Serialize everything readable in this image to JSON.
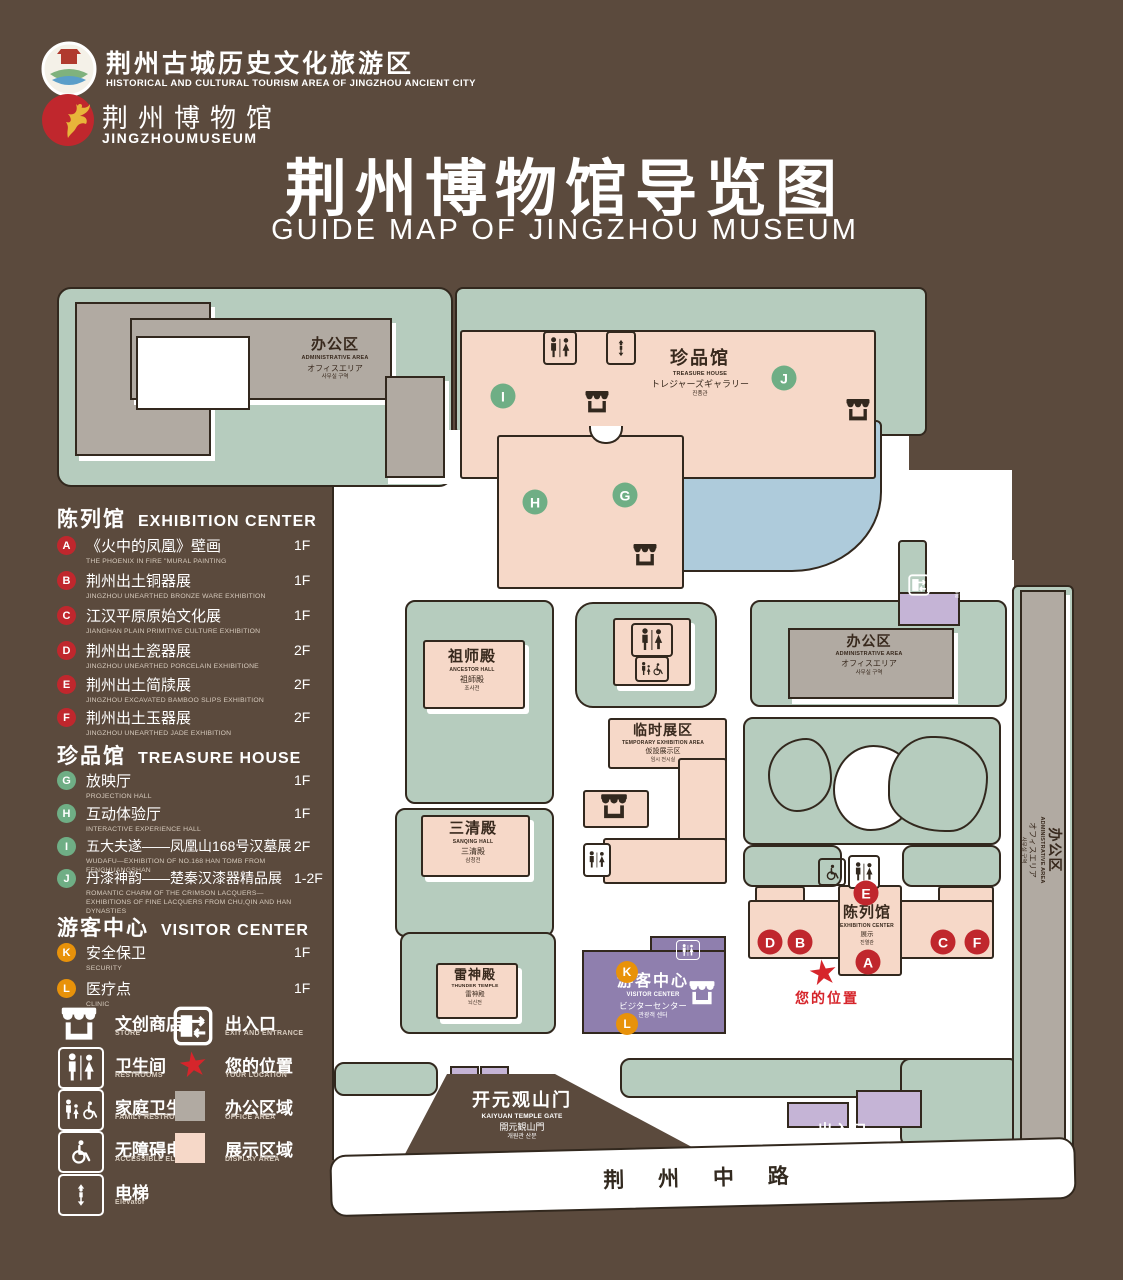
{
  "header": {
    "logo1": {
      "title": "荆州古城历史文化旅游区",
      "subtitle": "HISTORICAL AND CULTURAL TOURISM AREA OF JINGZHOU ANCIENT CITY"
    },
    "logo2": {
      "title": "荆州博物馆",
      "subtitle": "JINGZHOUMUSEUM"
    },
    "title": "荆州博物馆导览图",
    "subtitle": "GUIDE MAP OF JINGZHOU MUSEUM"
  },
  "legend": {
    "sections": [
      {
        "zh": "陈列馆",
        "en": "EXHIBITION CENTER",
        "items": [
          {
            "code": "A",
            "zh": "《火中的凤凰》壁画",
            "en": "THE PHOENIX IN FIRE \"MURAL PAINTING",
            "floor": "1F"
          },
          {
            "code": "B",
            "zh": "荆州出土铜器展",
            "en": "JINGZHOU UNEARTHED BRONZE WARE EXHIBITION",
            "floor": "1F"
          },
          {
            "code": "C",
            "zh": "江汉平原原始文化展",
            "en": "JIANGHAN PLAIN PRIMITIVE CULTURE EXHIBITION",
            "floor": "1F"
          },
          {
            "code": "D",
            "zh": "荆州出土瓷器展",
            "en": "JINGZHOU UNEARTHED PORCELAIN EXHIBITIONE",
            "floor": "2F"
          },
          {
            "code": "E",
            "zh": "荆州出土简牍展",
            "en": "JINGZHOU EXCAVATED BAMBOO SLIPS EXHIBITION",
            "floor": "2F"
          },
          {
            "code": "F",
            "zh": "荆州出土玉器展",
            "en": "JINGZHOU UNEARTHED JADE EXHIBITION",
            "floor": "2F"
          }
        ]
      },
      {
        "zh": "珍品馆",
        "en": "TREASURE HOUSE",
        "items": [
          {
            "code": "G",
            "zh": "放映厅",
            "en": "PROJECTION HALL",
            "floor": "1F"
          },
          {
            "code": "H",
            "zh": "互动体验厅",
            "en": "INTERACTIVE EXPERIENCE HALL",
            "floor": "1F"
          },
          {
            "code": "I",
            "zh": "五大夫遂——凤凰山168号汉墓展",
            "en": "WUDAFU—EXHIBITION OF NO.168 HAN TOMB FROM FENGHUANGSHAN",
            "floor": "2F"
          },
          {
            "code": "J",
            "zh": "丹漆神韵——楚秦汉漆器精品展",
            "en": "ROMANTIC CHARM OF THE CRIMSON LACQUERS—EXHIBITIONS OF FINE LACQUERS FROM CHU,QIN AND HAN DYNASTIES",
            "floor": "1-2F"
          }
        ]
      },
      {
        "zh": "游客中心",
        "en": "VISITOR CENTER",
        "items": [
          {
            "code": "K",
            "zh": "安全保卫",
            "en": "SECURITY",
            "floor": "1F"
          },
          {
            "code": "L",
            "zh": "医疗点",
            "en": "CLINIC",
            "floor": "1F"
          }
        ]
      }
    ],
    "symbols": [
      {
        "zh": "文创商店",
        "en": "STORE"
      },
      {
        "zh": "卫生间",
        "en": "RESTROOMS"
      },
      {
        "zh": "家庭卫生间",
        "en": "FAMILY RESTROOMS"
      },
      {
        "zh": "无障碍电梯",
        "en": "ACCESSIBLE ELEVATOR"
      },
      {
        "zh": "电梯",
        "en": "Elevator"
      },
      {
        "zh": "出入口",
        "en": "EXIT AND ENTRANCE"
      },
      {
        "zh": "您的位置",
        "en": "YOUR LOCATION"
      },
      {
        "zh": "办公区域",
        "en": "OFFICE AREA"
      },
      {
        "zh": "展示区域",
        "en": "DISPLAY AREA"
      }
    ]
  },
  "map": {
    "admin": {
      "zh": "办公区",
      "en": "ADMINISTRATIVE AREA",
      "ja": "オフィスエリア",
      "ko": "사무실 구역"
    },
    "treasure": {
      "zh": "珍品馆",
      "en": "TREASURE HOUSE",
      "ja": "トレジャーズギャラリー",
      "ko": "진품관"
    },
    "ancestor": {
      "zh": "祖师殿",
      "en": "ANCESTOR HALL",
      "ja": "祖師殿",
      "ko": "조사전"
    },
    "sanqing": {
      "zh": "三清殿",
      "en": "SANQING HALL",
      "ja": "三清殿",
      "ko": "삼청전"
    },
    "temporary": {
      "zh": "临时展区",
      "en": "TEMPORARY EXHIBITION AREA",
      "ja": "仮設展示区",
      "ko": "임시 전시실"
    },
    "thunder": {
      "zh": "雷神殿",
      "en": "THUNDER TEMPLE",
      "ja": "雷神殿",
      "ko": "뇌신전"
    },
    "exhibition": {
      "zh": "陈列馆",
      "en": "EXHIBITION CENTER",
      "ja": "展示",
      "ko": "진열관"
    },
    "visitor": {
      "zh": "游客中心",
      "en": "VISITOR CENTER",
      "ja": "ビジターセンター",
      "ko": "관광객 센터"
    },
    "gate": {
      "zh": "开元观山门",
      "en": "KAIYUAN TEMPLE GATE",
      "ja": "開元観山門",
      "ko": "개원관 산문"
    },
    "exit": {
      "zh": "出入口",
      "en": "EXIT AND ENTRANCE",
      "ja": "出入口",
      "ko": "출입구"
    },
    "your_location": "您的位置",
    "road": "荆 州 中 路",
    "markers": {
      "A": "A",
      "B": "B",
      "C": "C",
      "D": "D",
      "E": "E",
      "F": "F",
      "G": "G",
      "H": "H",
      "I": "I",
      "J": "J",
      "K": "K",
      "L": "L"
    }
  },
  "colors": {
    "background": "#5b4a3d",
    "lawn": "#b6ccbe",
    "display_area": "#f6d8c8",
    "office_area": "#b1aaa2",
    "lake": "#aecbdb",
    "visitor": "#8f7fae",
    "marker_red": "#c0272d",
    "marker_green": "#6fae85",
    "marker_orange": "#e8920a",
    "star": "#d6252b"
  }
}
